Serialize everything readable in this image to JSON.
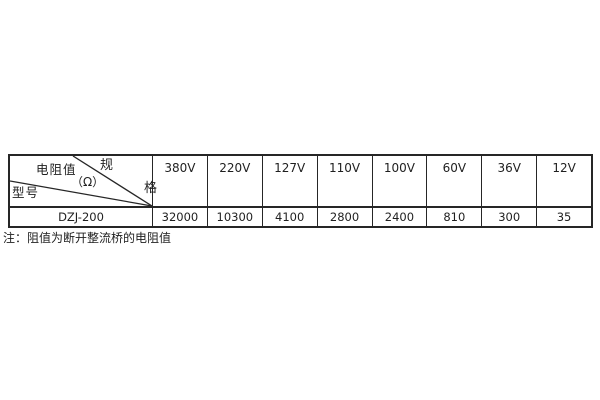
{
  "table": {
    "corner": {
      "spec_top": "规",
      "spec_bottom": "格",
      "resistance_label": "电阻值",
      "resistance_unit": "（Ω）",
      "model_label": "型号"
    },
    "columns": [
      "380V",
      "220V",
      "127V",
      "110V",
      "100V",
      "60V",
      "36V",
      "12V"
    ],
    "rows": [
      {
        "model": "DZJ-200",
        "values": [
          "32000",
          "10300",
          "4100",
          "2800",
          "2400",
          "810",
          "300",
          "35"
        ]
      }
    ]
  },
  "note": "注：阻值为断开整流桥的电阻值",
  "colors": {
    "border": "#262626",
    "text": "#1f1f1f",
    "background": "#ffffff"
  },
  "chart_data": {
    "type": "table",
    "title": "DZJ-200 电阻值规格表",
    "categories": [
      "380V",
      "220V",
      "127V",
      "110V",
      "100V",
      "60V",
      "36V",
      "12V"
    ],
    "series": [
      {
        "name": "DZJ-200",
        "values": [
          32000,
          10300,
          4100,
          2800,
          2400,
          810,
          300,
          35
        ]
      }
    ],
    "unit": "Ω"
  }
}
